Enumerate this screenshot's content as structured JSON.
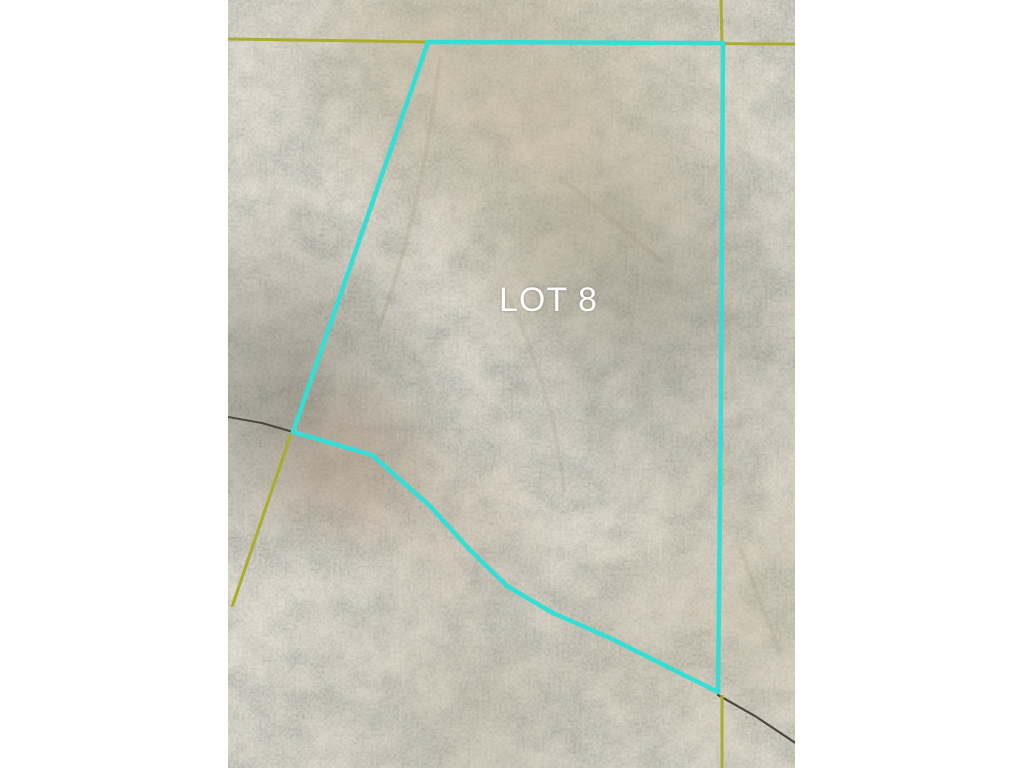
{
  "canvas": {
    "width": 1024,
    "height": 768,
    "background": "#ffffff"
  },
  "map": {
    "type": "aerial-parcel-map",
    "lot_label": {
      "text": "LOT 8",
      "color": "#ffffff"
    },
    "photo": {
      "base_color": "#7d7768"
    },
    "lot_boundary": {
      "color": "#35ddd4",
      "stroke_width": 4.5,
      "points": "428,42 723,43 721,400 718,692 610,638 553,613 507,586 468,548 430,506 372,455 293,432"
    },
    "parcel_lines": {
      "color": "#a9ad2e",
      "stroke_width": 3,
      "segments": [
        "228,39 428,42",
        "428,42 795,44",
        "721,0 722,43",
        "722,695 722,768",
        "291,434 232,607"
      ]
    },
    "trails": {
      "color": "#35312a",
      "segments": [
        "228,417 262,423 293,432",
        "718,695 755,716 797,744"
      ]
    }
  }
}
